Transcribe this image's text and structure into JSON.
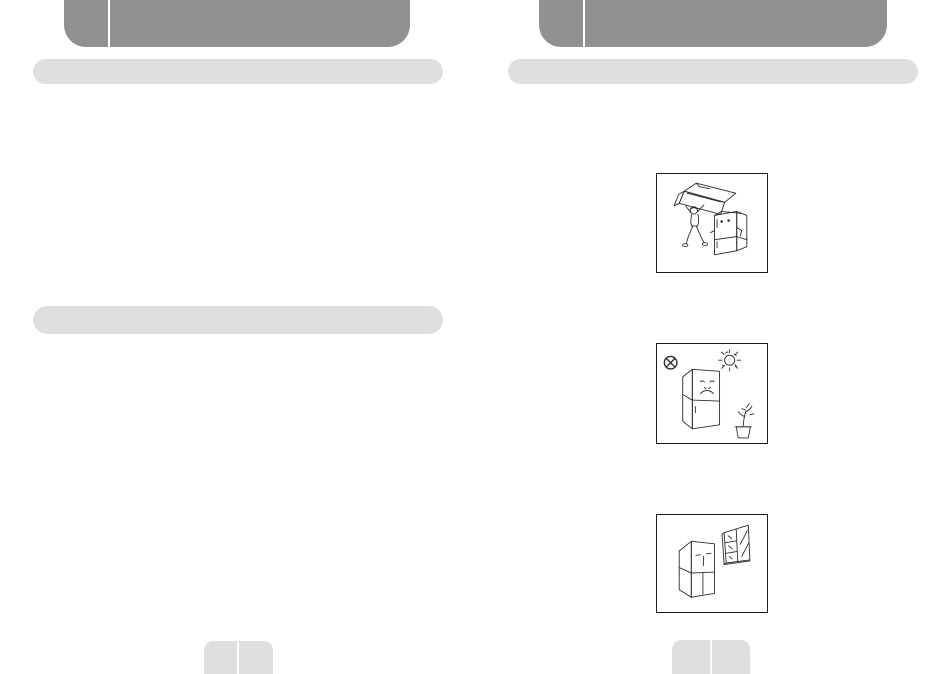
{
  "document": {
    "kind": "scanned appliance manual two-page spread; heading and body text areas are blank placeholder bars",
    "colors": {
      "header_gray": "#919191",
      "bar_gray": "#dfdfdf",
      "ink": "#2e2e2e",
      "paper": "#ffffff"
    }
  },
  "left_page": {
    "header_bar": {
      "description": "blank chapter header bar with small index tab segment"
    },
    "section_bars": [
      {
        "description": "blank section heading bar (top)"
      },
      {
        "description": "blank section heading bar (middle)"
      }
    ],
    "footer_tab": {
      "description": "blank two-segment page number tab"
    }
  },
  "right_page": {
    "header_bar": {
      "description": "blank chapter header bar with small index tab segment"
    },
    "section_bars": [
      {
        "description": "blank section heading bar (top)"
      }
    ],
    "illustrations": [
      {
        "id": "carry",
        "description": "Person carrying the packaged refrigerator box overhead next to an unpacked refrigerator"
      },
      {
        "id": "no-sunlight",
        "description": "Refrigerator with sad face under a bright sun beside a potted plant, with crossed-circle prohibition symbol"
      },
      {
        "id": "window",
        "description": "Refrigerator with a face beside an open window with diagonal rain lines"
      }
    ],
    "footer_tab": {
      "description": "blank two-segment page number tab"
    }
  }
}
